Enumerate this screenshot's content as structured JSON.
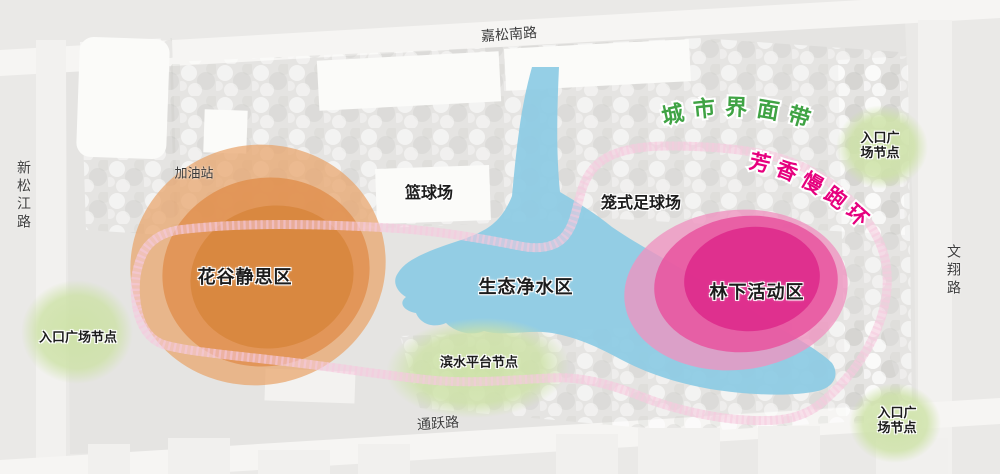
{
  "roads": {
    "top": "嘉松南路",
    "left": "新松江路",
    "right": "文翔路",
    "bottom": "通跃路"
  },
  "curved_labels": {
    "city_interface_belt": "城市界面带",
    "aromatic_jogging_loop": "芳香慢跑环"
  },
  "zones": {
    "gas_station": "加油站",
    "basketball_court": "篮球场",
    "cage_football_field": "笼式足球场",
    "flower_valley_meditation": "花谷静思区",
    "eco_water_purification": "生态净水区",
    "forest_activity": "林下活动区"
  },
  "nodes": {
    "entrance_plaza_left": "入口广场节点",
    "waterfront_platform": "滨水平台节点",
    "entrance_plaza_top_right_line1": "入口广",
    "entrance_plaza_top_right_line2": "场节点",
    "entrance_plaza_bottom_right_line1": "入口广",
    "entrance_plaza_bottom_right_line2": "场节点"
  },
  "colors": {
    "background": "#eae9e7",
    "site": "#e5e4e2",
    "road_band": "#f7f6f4",
    "water": "#8ccbe4",
    "orange_outer": "#e9a369",
    "orange_inner": "#d8873f",
    "pink_outer": "#ef93c0",
    "pink_inner": "#dd2d8c",
    "node_green": "#cde2a6",
    "track_magenta": "#d42680",
    "green_text": "#3fa344",
    "pink_text": "#e6007e"
  }
}
